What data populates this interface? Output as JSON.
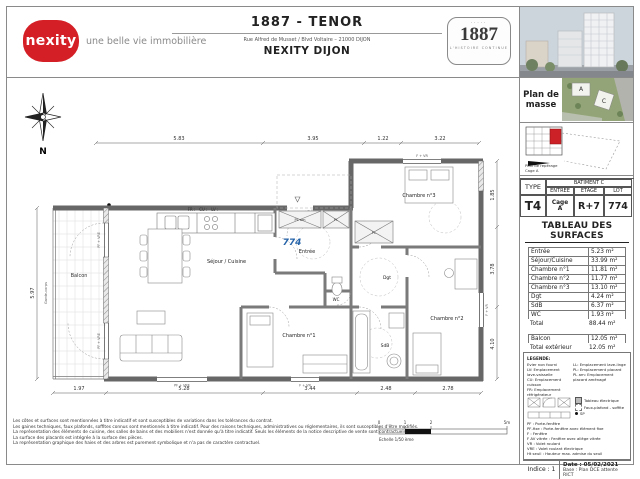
{
  "header": {
    "brand": "nexity",
    "tagline": "une belle vie immobilière",
    "title": "1887 - TENOR",
    "address": "Rue Alfred de Musset / Blvd Voltaire – 21000 DIJON",
    "agency": "NEXITY DIJON",
    "badge": "1887",
    "badge_sub": "L'HISTOIRE CONTINUE"
  },
  "sidebar": {
    "plan_masse": {
      "label_line1": "Plan de",
      "label_line2": "masse",
      "building_a": "A",
      "building_c": "C"
    },
    "reperage": {
      "label": "Plan de repérage",
      "cage": "Cage A"
    },
    "type_table": {
      "type_header": "TYPE",
      "batiment": "BATIMENT C",
      "cols": [
        "ENTREE",
        "ETAGE",
        "LOT"
      ],
      "type": "T4",
      "entree_line1": "Cage",
      "entree_line2": "A",
      "etage": "R+7",
      "lot": "774"
    },
    "surfaces": {
      "title": "TABLEAU DES SURFACES",
      "rows": [
        {
          "label": "Entrée",
          "value": "5.23 m²"
        },
        {
          "label": "Séjour/Cuisine",
          "value": "33.99 m²"
        },
        {
          "label": "Chambre n°1",
          "value": "11.81 m²"
        },
        {
          "label": "Chambre n°2",
          "value": "11.77 m²"
        },
        {
          "label": "Chambre n°3",
          "value": "13.10 m²"
        },
        {
          "label": "Dgt",
          "value": "4.24 m²"
        },
        {
          "label": "SdB",
          "value": "6.37 m²"
        },
        {
          "label": "WC",
          "value": "1.93 m²"
        }
      ],
      "total": {
        "label": "Total",
        "value": "88.44 m²"
      },
      "balcon": {
        "label": "Balcon",
        "value": "12.05 m²"
      },
      "total_ext": {
        "label": "Total extérieur",
        "value": "12.05 m²"
      }
    },
    "legend": {
      "title": "LEGENDE:",
      "left_lines": [
        "Evier non fourni",
        "LV: Emplacement lave-vaisselle",
        "CU: Emplacement cuisson",
        "FR: Emplacement réfrigérateur"
      ],
      "right_lines": [
        "LL: Emplacement lave-linge",
        "PL: Emplacement placard",
        "PL am: Emplacement placard aménagé"
      ],
      "tableau_electrique": "Tableau électrique",
      "faux_plafond": "Faux-plafond - soffite",
      "sp": "SP",
      "window_lines": [
        "PF : Porte-fenêtre",
        "PF-fixe : Porte-fenêtre avec élément fixe",
        "F : Fenêtre",
        "F AV vitrée : Fenêtre avec allège vitrée",
        "VR : Volet roulant",
        "VRE : Volet roulant électrique",
        "Ht seuil : Hauteur max. admise du seuil"
      ],
      "indice": "Indice : 1",
      "date": "Date : 05/02/2021",
      "base": "Base : Plan DCE attente RICT"
    }
  },
  "plan": {
    "north": "N",
    "lot": "774",
    "rooms": {
      "sejour": "Séjour / Cuisine",
      "entree": "Entrée",
      "chambre1": "Chambre n°1",
      "chambre2": "Chambre n°2",
      "chambre3": "Chambre n°3",
      "dgt": "Dgt",
      "sdb": "SdB",
      "wc": "WC",
      "pl": "PL",
      "pl_am": "PL am",
      "balcon": "Balcon",
      "garde_corps": "Garde-corps"
    },
    "annotations": {
      "kitchen": "FR :   CU :   LV :",
      "window_pf": "PF + VRE",
      "window_f": "F + VR"
    },
    "dims": {
      "top": [
        "5.83",
        "3.95",
        "1.22",
        "3.22"
      ],
      "bottom": [
        "1.97",
        "5.28",
        "3.44",
        "2.48",
        "2.78"
      ],
      "left": "5.97",
      "right": [
        "1.85",
        "3.78",
        "4.10"
      ]
    }
  },
  "footer": {
    "disclaimers": [
      "Les côtes et surfaces sont mentionnées à titre indicatif et sont susceptibles de variations dans les tolérances du contrat.",
      "Les gaines techniques, faux plafonds, soffites connus sont mentionnés à titre indicatif. Pour des raisons techniques, administratives ou réglementaires, ils sont susceptibles d'être modifiés.",
      "La représentation des éléments de cuisine, des salles de bains et des mobiliers n'est donnée qu'à titre indicatif. Seuls les éléments de la notice descriptive de vente sont contractuels.",
      "La surface des placards est intégrée à la surface des pièces.",
      "La représentation graphique des haies et des arbres est purement symbolique et n'a pas de caractère contractuel."
    ],
    "scale": {
      "t0": "0",
      "t1": "1",
      "t2": "2",
      "t5": "5m",
      "label": "Echelle 1/50 ème"
    }
  }
}
